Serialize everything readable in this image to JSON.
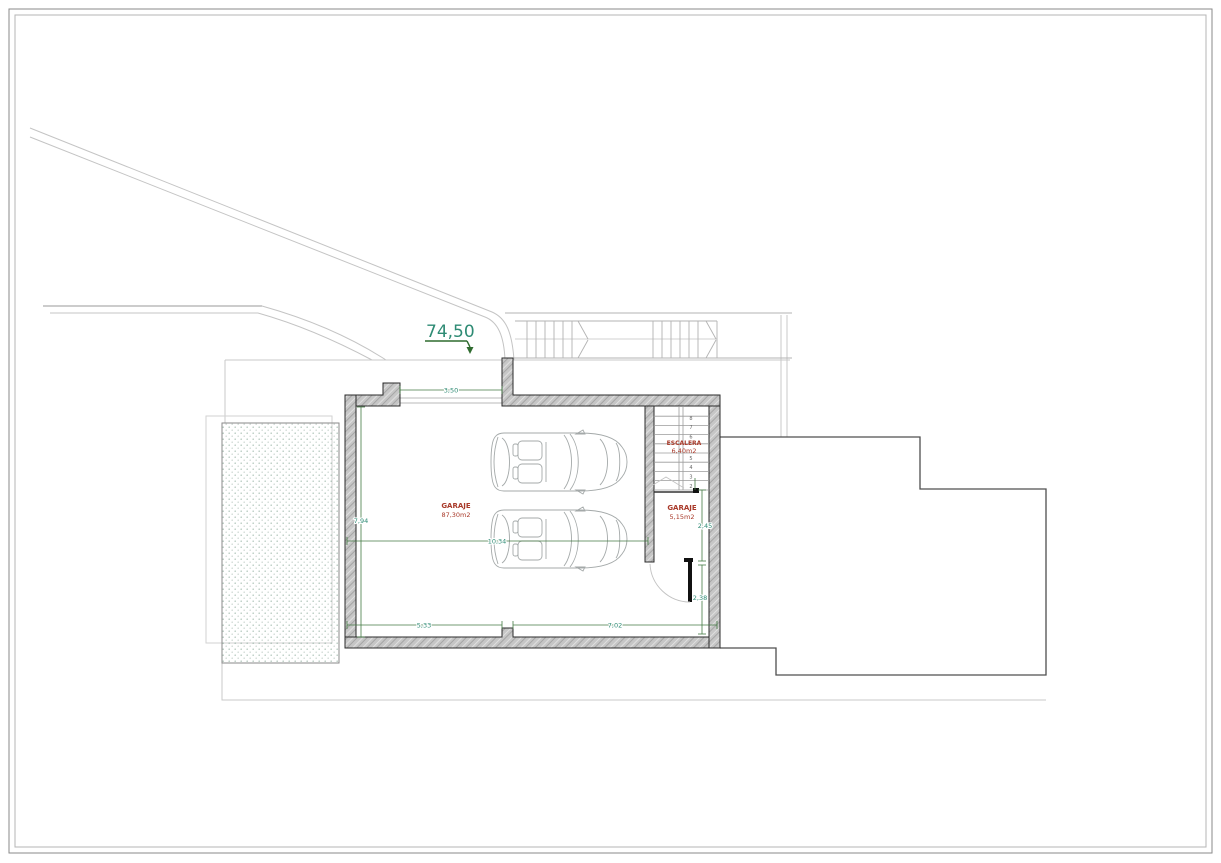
{
  "level_marker": "74,50",
  "rooms": {
    "garage_main": {
      "name": "GARAJE",
      "area": "87,30m2"
    },
    "staircase": {
      "name": "ESCALERA",
      "area": "6,40m2"
    },
    "garage_small": {
      "name": "GARAJE",
      "area": "5,15m2"
    }
  },
  "dimensions": {
    "garage_door_width": "3,50",
    "garage_depth": "7,94",
    "garage_width": "10,34",
    "bottom_left_span": "5,33",
    "bottom_right_span": "7,02",
    "small_garage_height": "2,45",
    "door_bay_height": "2,38"
  },
  "staircase_steps": [
    "1",
    "2",
    "3",
    "4",
    "5",
    "6",
    "7",
    "8"
  ],
  "colors": {
    "dimension_text": "#2e8b74",
    "dimension_line": "#457a45",
    "room_label": "#a93a2a",
    "wall_fill": "#c6c6c6",
    "level_marker": "#2e8b74"
  }
}
